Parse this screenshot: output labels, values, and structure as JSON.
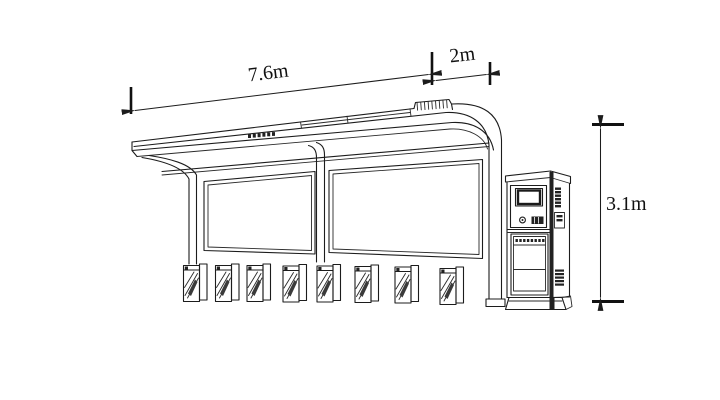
{
  "drawing": {
    "subject": "Bus shelter elevation drawing with canopy, two advertising panels, eight seat stools and an information kiosk",
    "background_color": "#ffffff",
    "line_color": "#1c1c1c"
  },
  "dimensions": {
    "width_label": "7.6m",
    "depth_label": "2m",
    "height_label": "3.1m"
  },
  "structure": {
    "panel_count": 2,
    "seat_count": 8,
    "canopy_rib_count": 9
  }
}
